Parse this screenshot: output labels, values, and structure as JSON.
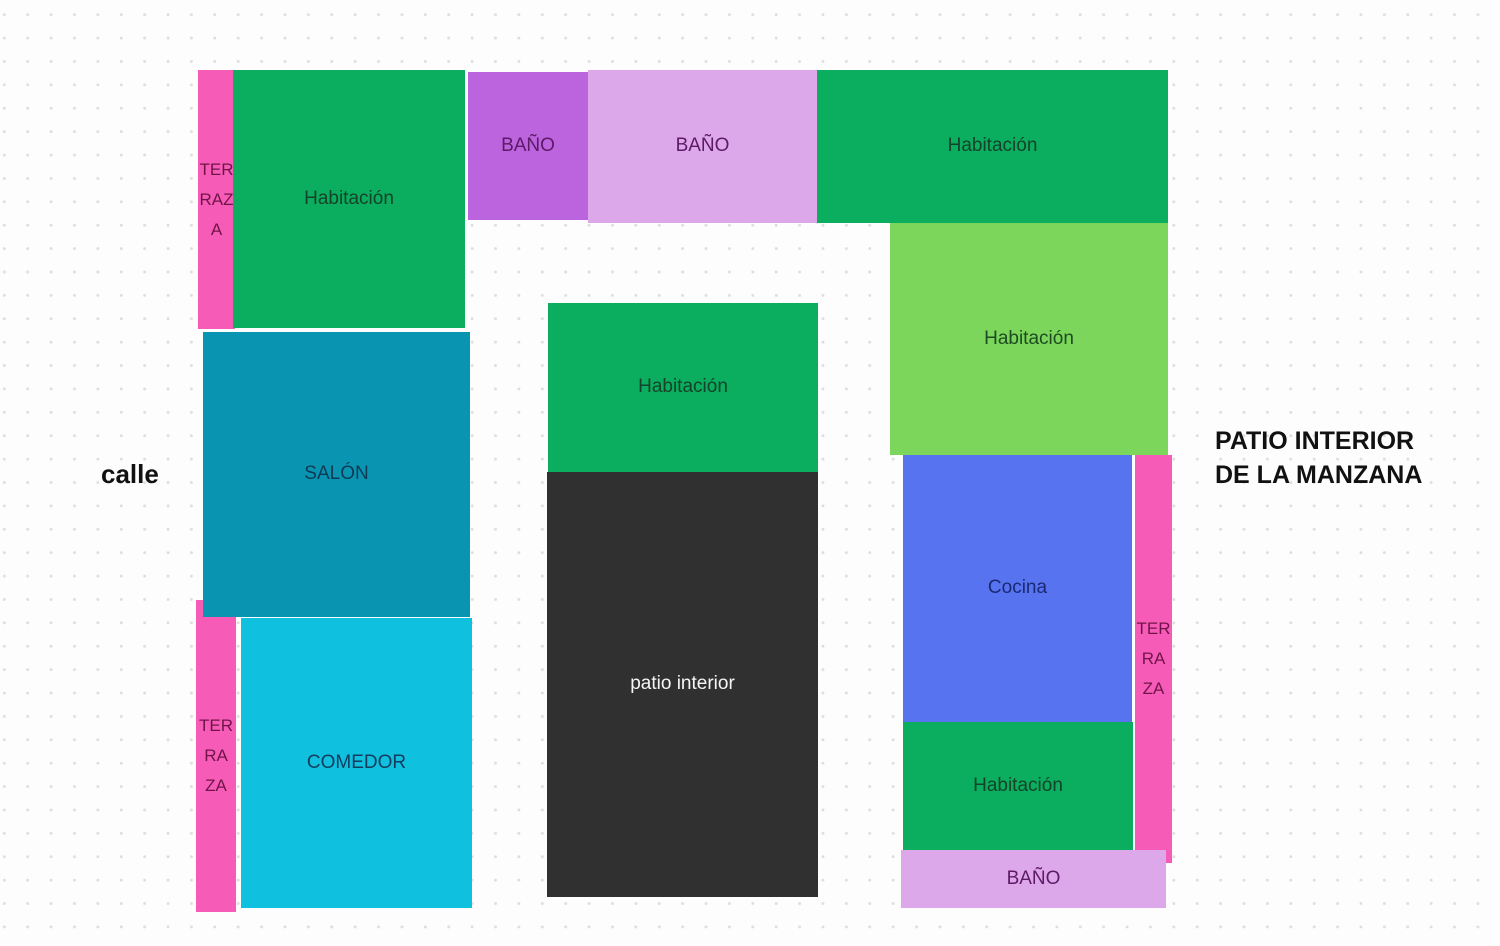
{
  "page": {
    "background_color": "#fdfdfd",
    "dot_grid_color": "#dedede"
  },
  "annotations": {
    "street_label": "calle",
    "patio_manzana_line1": "PATIO INTERIOR",
    "patio_manzana_line2": "DE LA MANZANA"
  },
  "rooms": {
    "terraza_top_left": {
      "lines": [
        "TER",
        "RAZ",
        "A"
      ],
      "color": "#f65cb7"
    },
    "habitacion_top_left": {
      "label": "Habitación",
      "color": "#0bae5e"
    },
    "bano_top_purple": {
      "label": "BAÑO",
      "color": "#bb64de"
    },
    "bano_top_light": {
      "label": "BAÑO",
      "color": "#dca8e9"
    },
    "habitacion_top_right": {
      "label": "Habitación",
      "color": "#0bae5e"
    },
    "habitacion_right": {
      "label": "Habitación",
      "color": "#7dd65c"
    },
    "salon": {
      "label": "SALÓN",
      "color": "#0995b2"
    },
    "terraza_bottom_left": {
      "lines": [
        "TER",
        "RA",
        "ZA"
      ],
      "color": "#f65cb7"
    },
    "comedor": {
      "label": "COMEDOR",
      "color": "#0fc0df"
    },
    "habitacion_middle": {
      "label": "Habitación",
      "color": "#0bae5e"
    },
    "patio_interior": {
      "label": "patio interior",
      "color": "#303030"
    },
    "cocina": {
      "label": "Cocina",
      "color": "#5873f0"
    },
    "terraza_right": {
      "lines": [
        "TER",
        "RA",
        "ZA"
      ],
      "color": "#f65cb7"
    },
    "habitacion_bottom_right": {
      "label": "Habitación",
      "color": "#0bae5e"
    },
    "bano_bottom": {
      "label": "BAÑO",
      "color": "#dca8e9"
    }
  }
}
